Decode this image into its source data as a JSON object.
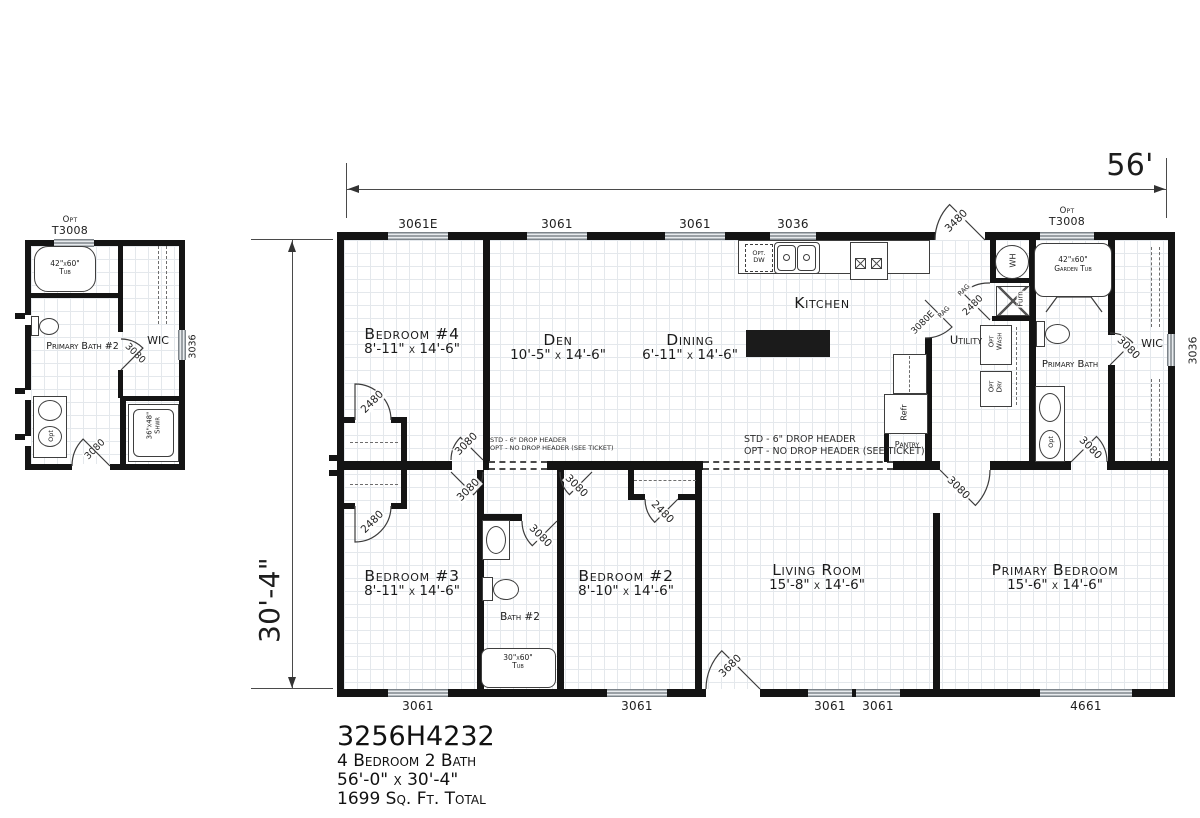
{
  "title_block": {
    "model": "3256H4232",
    "line1": "4 Bedroom 2 Bath",
    "line2": "56'-0\" x 30'-4\"",
    "line3": "1699 Sq. Ft. Total"
  },
  "dimensions": {
    "width": "56'",
    "depth": "30'-4\""
  },
  "notes": {
    "header_l1": "STD - 6\" DROP HEADER",
    "header_l2": "OPT - NO DROP HEADER (SEE TICKET)"
  },
  "rooms": {
    "bedroom4": {
      "name": "Bedroom #4",
      "size": "8'-11\" x 14'-6\""
    },
    "den": {
      "name": "Den",
      "size": "10'-5\" x 14'-6\""
    },
    "dining": {
      "name": "Dining",
      "size": "6'-11\" x 14'-6\""
    },
    "kitchen": {
      "name": "Kitchen"
    },
    "utility": {
      "name": "Utility"
    },
    "primary_bath": {
      "name": "Primary Bath"
    },
    "wic": {
      "name": "WIC"
    },
    "pantry": {
      "name": "Pantry"
    },
    "bedroom3": {
      "name": "Bedroom #3",
      "size": "8'-11\" x 14'-6\""
    },
    "bath2": {
      "name": "Bath #2"
    },
    "bedroom2": {
      "name": "Bedroom #2",
      "size": "8'-10\" x 14'-6\""
    },
    "living": {
      "name": "Living Room",
      "size": "15'-8\" x 14'-6\""
    },
    "primary_bedroom": {
      "name": "Primary Bedroom",
      "size": "15'-6\" x 14'-6\""
    }
  },
  "windows": {
    "top1": "3061E",
    "top2": "3061",
    "top3": "3061",
    "top4": "3036",
    "top5_opt": "Opt",
    "top5": "T3008",
    "bottom1": "3061",
    "bottom2": "3061",
    "bottom3": "3061",
    "bottom4": "3061",
    "bottom5": "4661",
    "right": "3036"
  },
  "doors": {
    "rear": "3480",
    "kitchen_rear": "3080E",
    "rag": "RAG",
    "utility": "2480",
    "bed4": "3080",
    "bed4_closet": "2480",
    "bed3": "3080",
    "bed3_closet": "2480",
    "bed2": "3080",
    "bed2_closet": "2480",
    "bath2": "3080",
    "living": "3080",
    "front": "3680",
    "primary_bath": "3080",
    "primary_wic": "3080"
  },
  "fixtures": {
    "dw_l1": "Opt.",
    "dw_l2": "DW",
    "refr": "Refr",
    "wh": "WH",
    "furn": "Furn",
    "wash_l1": "Opt",
    "wash_l2": "Wash",
    "dry_l1": "Opt",
    "dry_l2": "Dry",
    "gtub_opt": "Opt",
    "gtub_model": "T3008",
    "gtub_l1": "42\"x60\"",
    "gtub_l2": "Garden Tub",
    "tub2_l1": "30\"x60\"",
    "tub2_l2": "Tub",
    "sink_opt": "Opt"
  },
  "inset": {
    "opt": "Opt",
    "model": "T3008",
    "tub_l1": "42\"x60\"",
    "tub_l2": "Tub",
    "room": "Primary Bath #2",
    "wic": "WIC",
    "window": "3036",
    "door_wic": "3080",
    "door_entry": "3080",
    "shwr_l1": "36\"x48\"",
    "shwr_l2": "Shwr",
    "sink_opt": "Opt"
  }
}
